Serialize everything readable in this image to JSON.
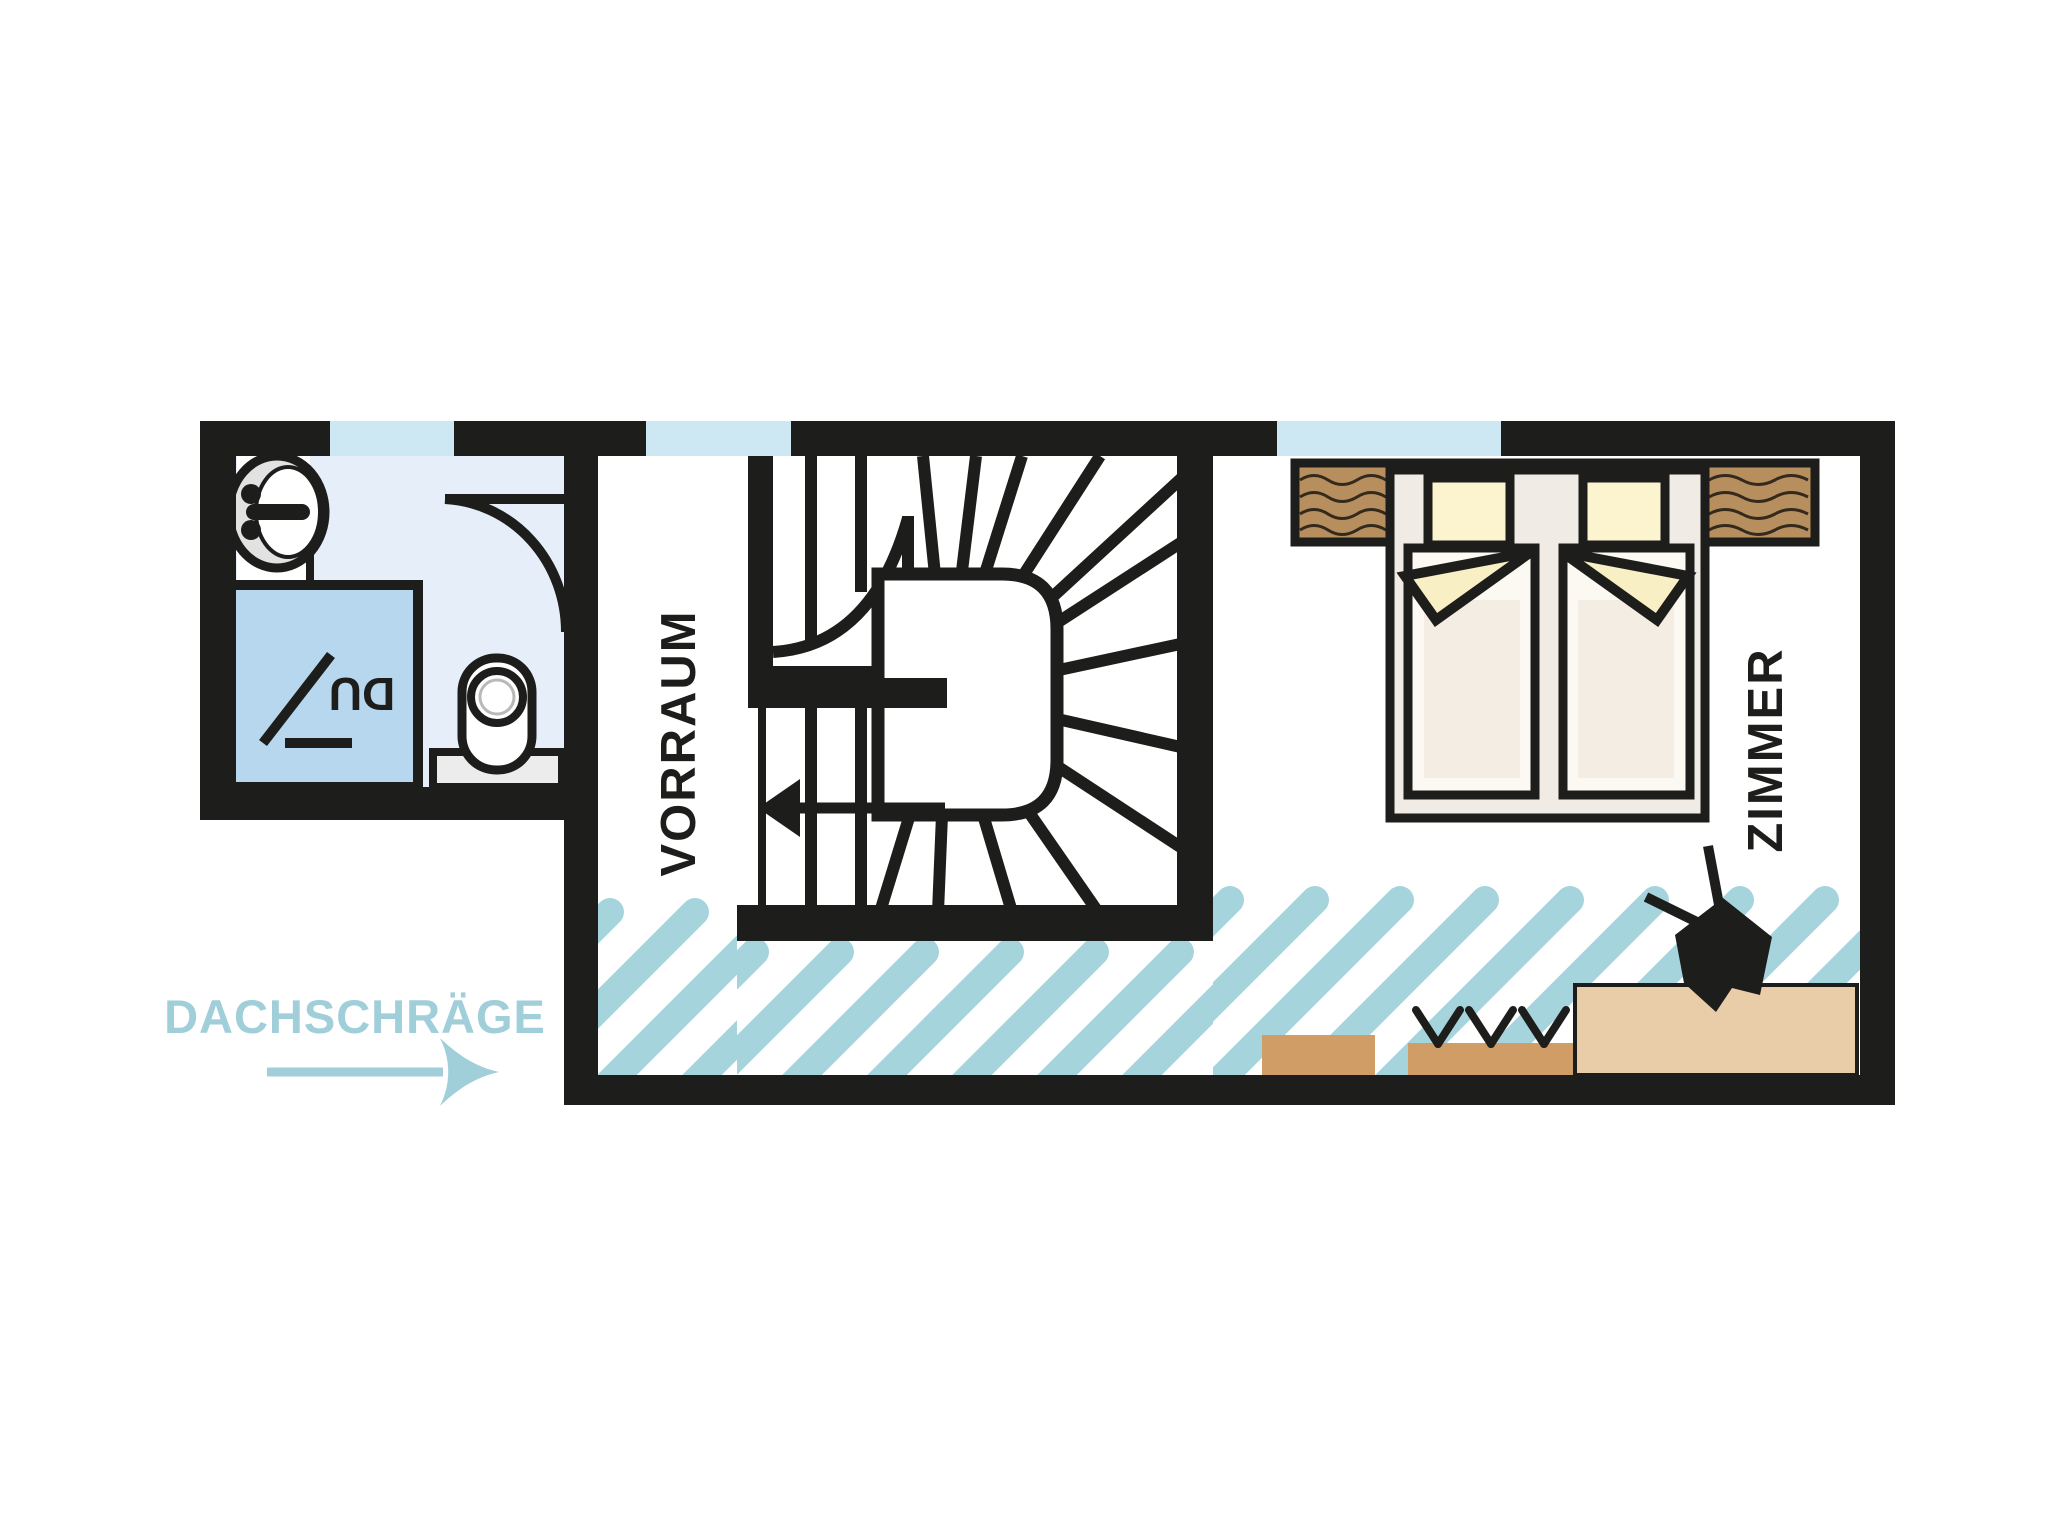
{
  "labels": {
    "hallway": "VORRAUM",
    "bedroom": "ZIMMER",
    "shower": "DU",
    "roof_slope": "DACHSCHRÄGE"
  },
  "colors": {
    "wall": "#1d1d1b",
    "window": "#cde7f3",
    "bath-floor": "#e6eff9",
    "shower": "#b6d7ed",
    "fixture-gray": "#e2e2e2",
    "cistern-gray": "#ececec",
    "hatch": "#a6d4dd",
    "label-blue": "#a0ced9",
    "wood": "#b78e5e",
    "wood-grain": "#33291c",
    "tan-dark": "#d09d66",
    "tan-light": "#e9cda9",
    "bed-frame": "#f1ebe5",
    "mattress": "#fcf9f3",
    "mattress-shade": "#f3ede4",
    "pillow": "#fbf4cf",
    "duvet": "#f8f0c4"
  }
}
